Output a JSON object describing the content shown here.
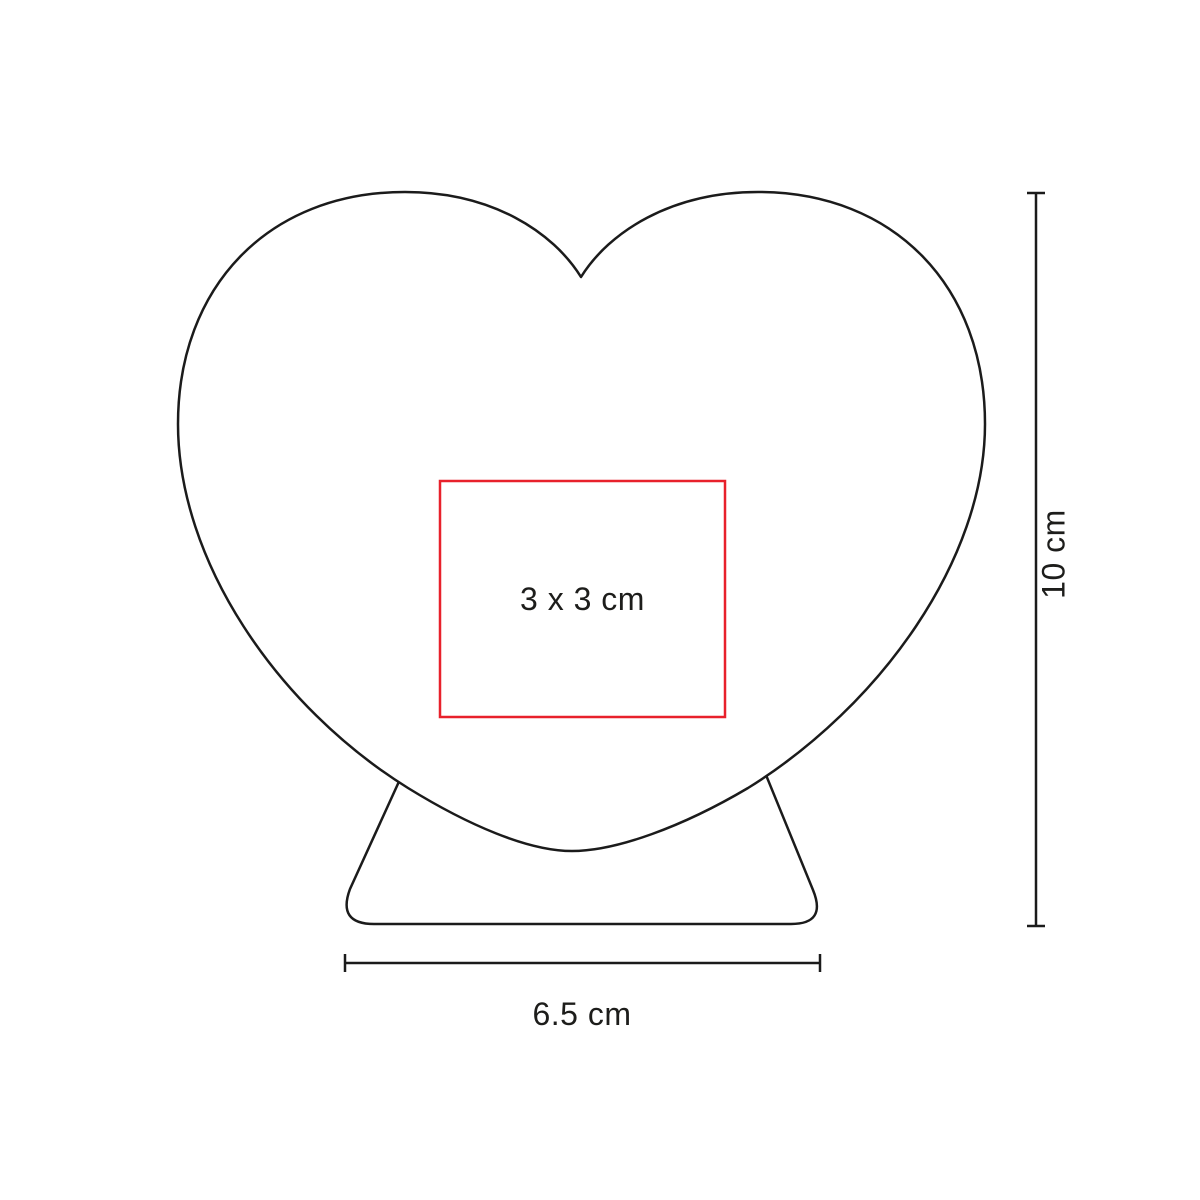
{
  "diagram": {
    "print_area": {
      "label": "3 x 3 cm",
      "color": "#e8212b"
    },
    "height_dimension": {
      "label": "10 cm"
    },
    "width_dimension": {
      "label": "6.5 cm"
    },
    "colors": {
      "outline": "#1b1b1b",
      "text": "#1d1d1b",
      "background": "#ffffff"
    }
  }
}
